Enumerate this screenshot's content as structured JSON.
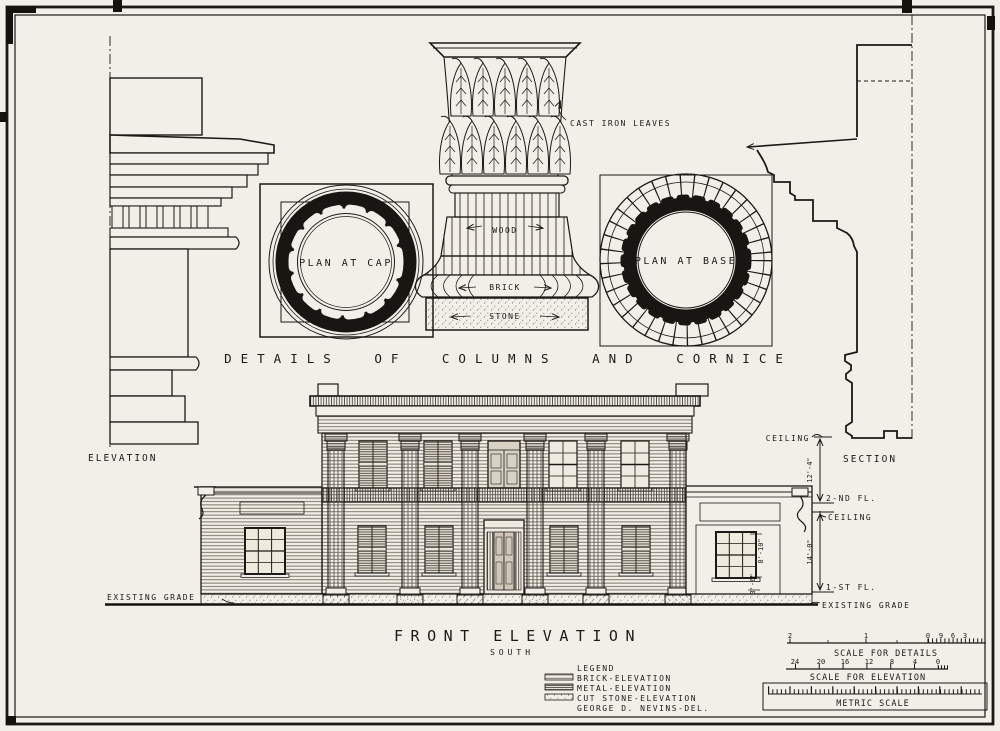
{
  "sheet": {
    "details_title": "DETAILS OF COLUMNS AND CORNICE",
    "labels": {
      "elevation": "ELEVATION",
      "section": "SECTION",
      "plan_at_cap": "PLAN AT CAP",
      "plan_at_base": "PLAN AT BASE",
      "cast_iron_leaves": "CAST IRON LEAVES",
      "wood": "WOOD",
      "brick": "BRICK",
      "stone": "STONE"
    },
    "front_elevation": {
      "title": "FRONT ELEVATION",
      "subtitle": "SOUTH",
      "existing_grade_left": "EXISTING GRADE",
      "existing_grade_right": "EXISTING GRADE",
      "ceiling_upper": "CEILING",
      "ceiling_lower": "CEILING",
      "second_floor": "2-ND FL.",
      "first_floor": "1-ST FL.",
      "dim_upper": "12'-4\"",
      "dim_lower": "14'-0\"",
      "window_dim_height": "8'-10\"",
      "window_dim_sill": "3'-6\""
    },
    "legend": {
      "title": "LEGEND",
      "items": [
        {
          "name": "brick",
          "label": "BRICK-ELEVATION"
        },
        {
          "name": "metal",
          "label": "METAL-ELEVATION"
        },
        {
          "name": "stone",
          "label": "CUT STONE-ELEVATION"
        }
      ],
      "credit": "GEORGE D. NEVINS-DEL."
    },
    "scales": {
      "details": {
        "label": "SCALE FOR DETAILS",
        "ticks": [
          "2",
          "1",
          "0",
          "9",
          "6",
          "3"
        ]
      },
      "elevation": {
        "label": "SCALE FOR ELEVATION",
        "ticks": [
          "24",
          "20",
          "16",
          "12",
          "8",
          "4",
          "0"
        ]
      },
      "metric": {
        "label": "METRIC SCALE"
      }
    },
    "colors": {
      "paper": "#f2efe8",
      "ink": "#1c1a17"
    }
  }
}
